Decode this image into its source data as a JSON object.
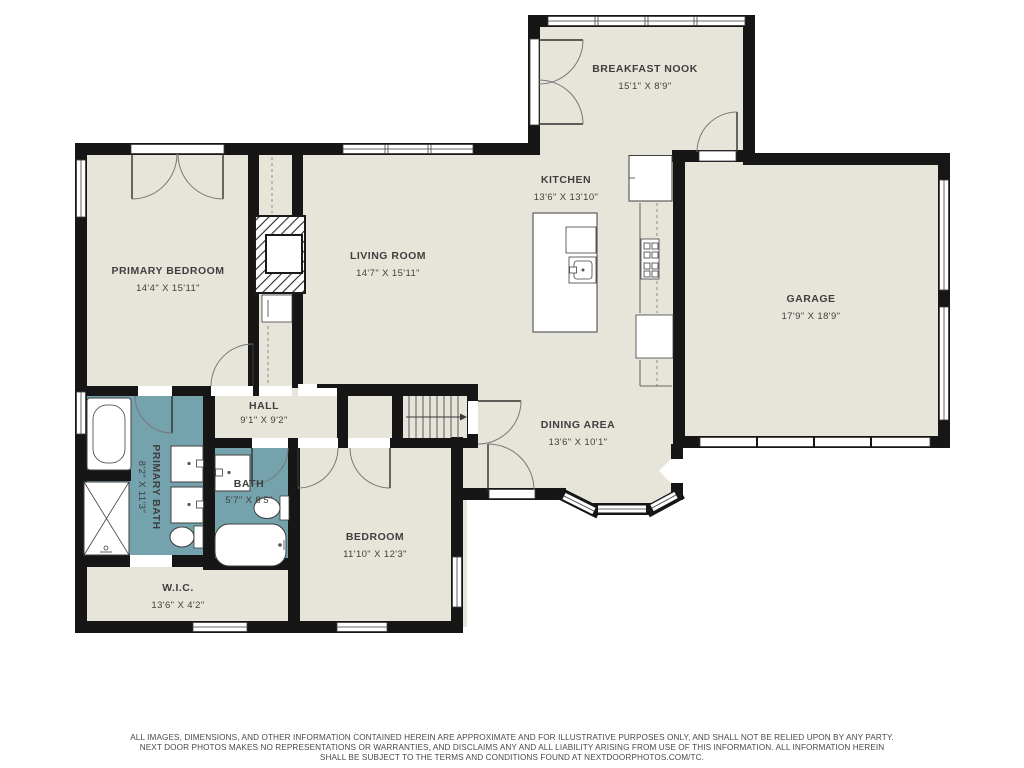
{
  "rooms": {
    "breakfast_nook": {
      "name": "BREAKFAST NOOK",
      "dims": "15'1\" X 8'9\""
    },
    "kitchen": {
      "name": "KITCHEN",
      "dims": "13'6\" X 13'10\""
    },
    "garage": {
      "name": "GARAGE",
      "dims": "17'9\" X 18'9\""
    },
    "living_room": {
      "name": "LIVING ROOM",
      "dims": "14'7\" X 15'11\""
    },
    "primary_bedroom": {
      "name": "PRIMARY BEDROOM",
      "dims": "14'4\" X 15'11\""
    },
    "dining_area": {
      "name": "DINING AREA",
      "dims": "13'6\" X 10'1\""
    },
    "hall": {
      "name": "HALL",
      "dims": "9'1\" X 9'2\""
    },
    "primary_bath": {
      "name": "PRIMARY BATH",
      "dims": "8'2\" X 11'3\""
    },
    "bath": {
      "name": "BATH",
      "dims": "5'7\" X 8'5\""
    },
    "bedroom": {
      "name": "BEDROOM",
      "dims": "11'10\" X 12'3\""
    },
    "wic": {
      "name": "W.I.C.",
      "dims": "13'6\" X 4'2\""
    }
  },
  "disclaimer": {
    "line1": "ALL IMAGES, DIMENSIONS, AND OTHER INFORMATION CONTAINED HEREIN ARE APPROXIMATE AND FOR ILLUSTRATIVE PURPOSES ONLY, AND SHALL NOT BE RELIED UPON BY ANY PARTY.",
    "line2": "NEXT DOOR PHOTOS MAKES NO REPRESENTATIONS OR WARRANTIES, AND DISCLAIMS ANY AND ALL LIABILITY ARISING FROM USE OF THIS INFORMATION. ALL INFORMATION HEREIN",
    "line3": "SHALL BE SUBJECT TO THE TERMS AND CONDITIONS FOUND AT NEXTDOORPHOTOS.COM/TC."
  },
  "colors": {
    "floor": "#e7e5da",
    "wall": "#161616",
    "bath": "#74a2ad",
    "text": "#3f3f3f"
  }
}
